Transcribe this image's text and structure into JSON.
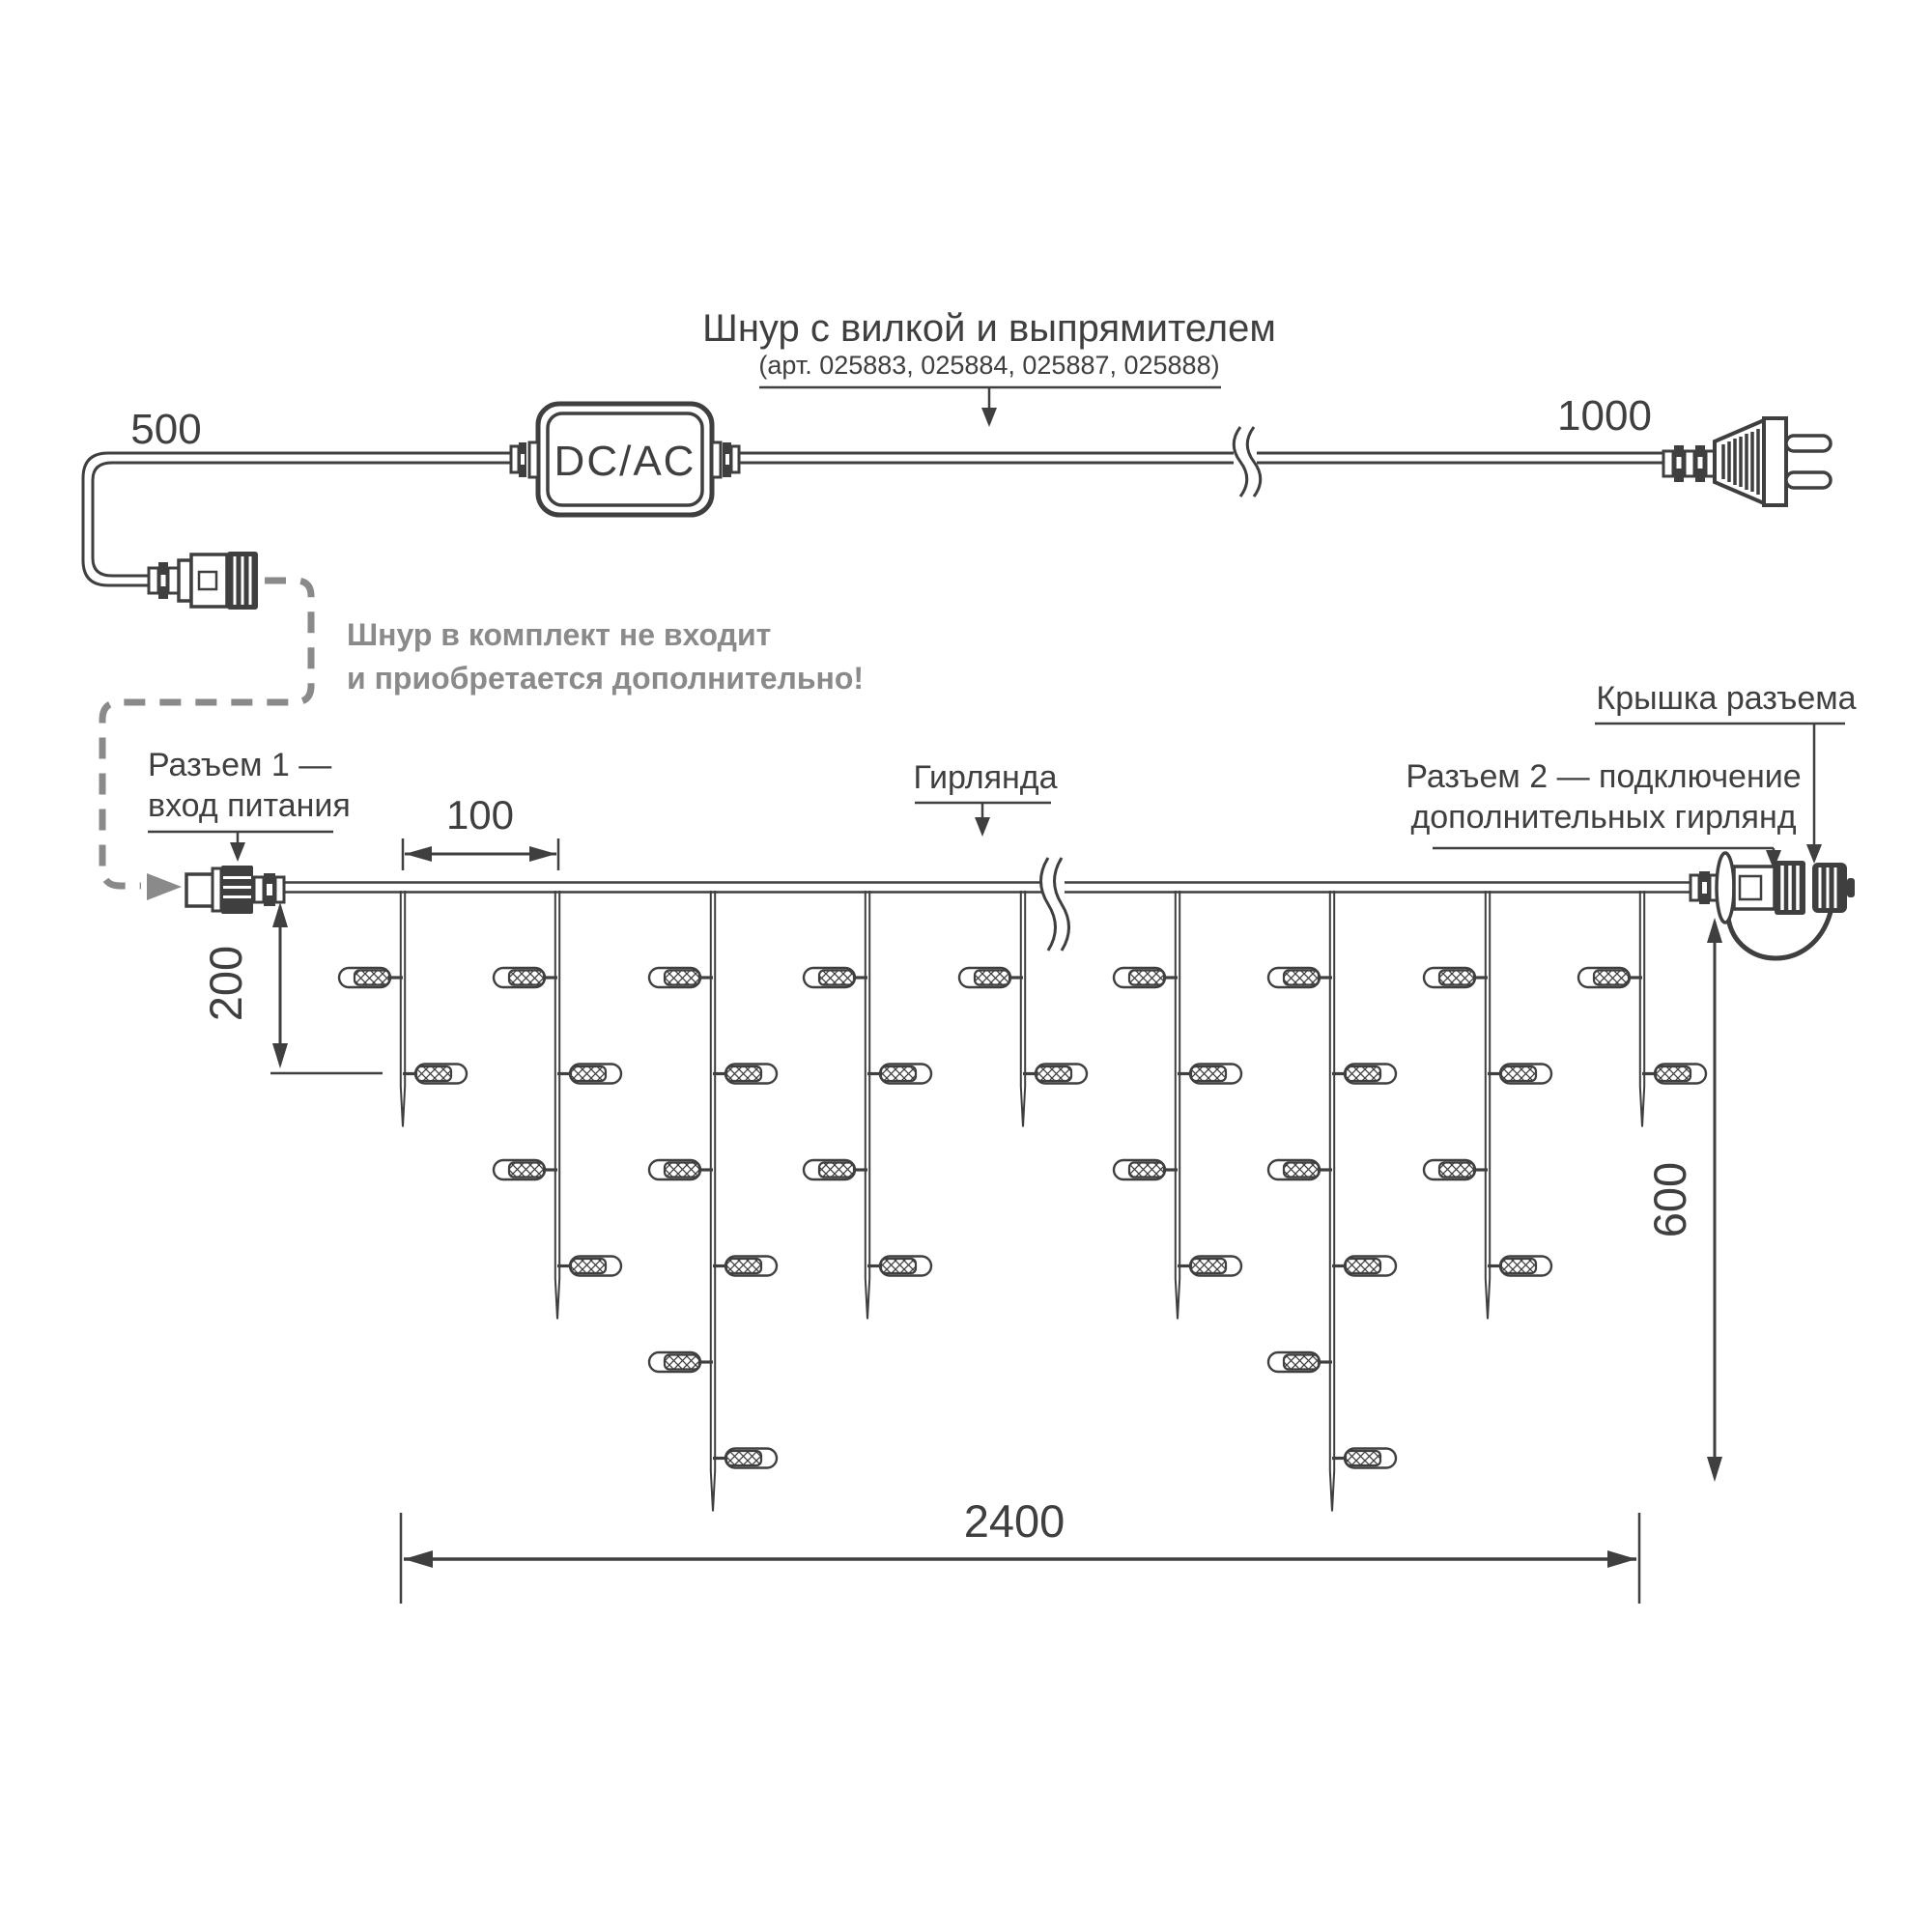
{
  "colors": {
    "line": "#3f3f3f",
    "note_gray": "#8a8a8a",
    "background": "#ffffff"
  },
  "top_section": {
    "dim_500": "500",
    "converter_label": "DC/AC",
    "cord_title": "Шнур с вилкой и выпрямителем",
    "cord_subtitle": "(арт. 025883, 025884, 025887, 025888)",
    "dim_1000": "1000",
    "note_line1": "Шнур в комплект не входит",
    "note_line2": "и приобретается дополнительно!"
  },
  "garland_section": {
    "connector1_label_line1": "Разъем 1 —",
    "connector1_label_line2": "вход питания",
    "garland_label": "Гирлянда",
    "cap_label": "Крышка разъема",
    "connector2_label_line1": "Разъем 2 — подключение",
    "connector2_label_line2": "дополнительных гирлянд",
    "dim_100": "100",
    "dim_200": "200",
    "dim_600": "600",
    "dim_2400": "2400",
    "drops_bulb_counts": [
      2,
      4,
      6,
      4,
      2,
      4,
      6,
      4,
      2
    ]
  }
}
